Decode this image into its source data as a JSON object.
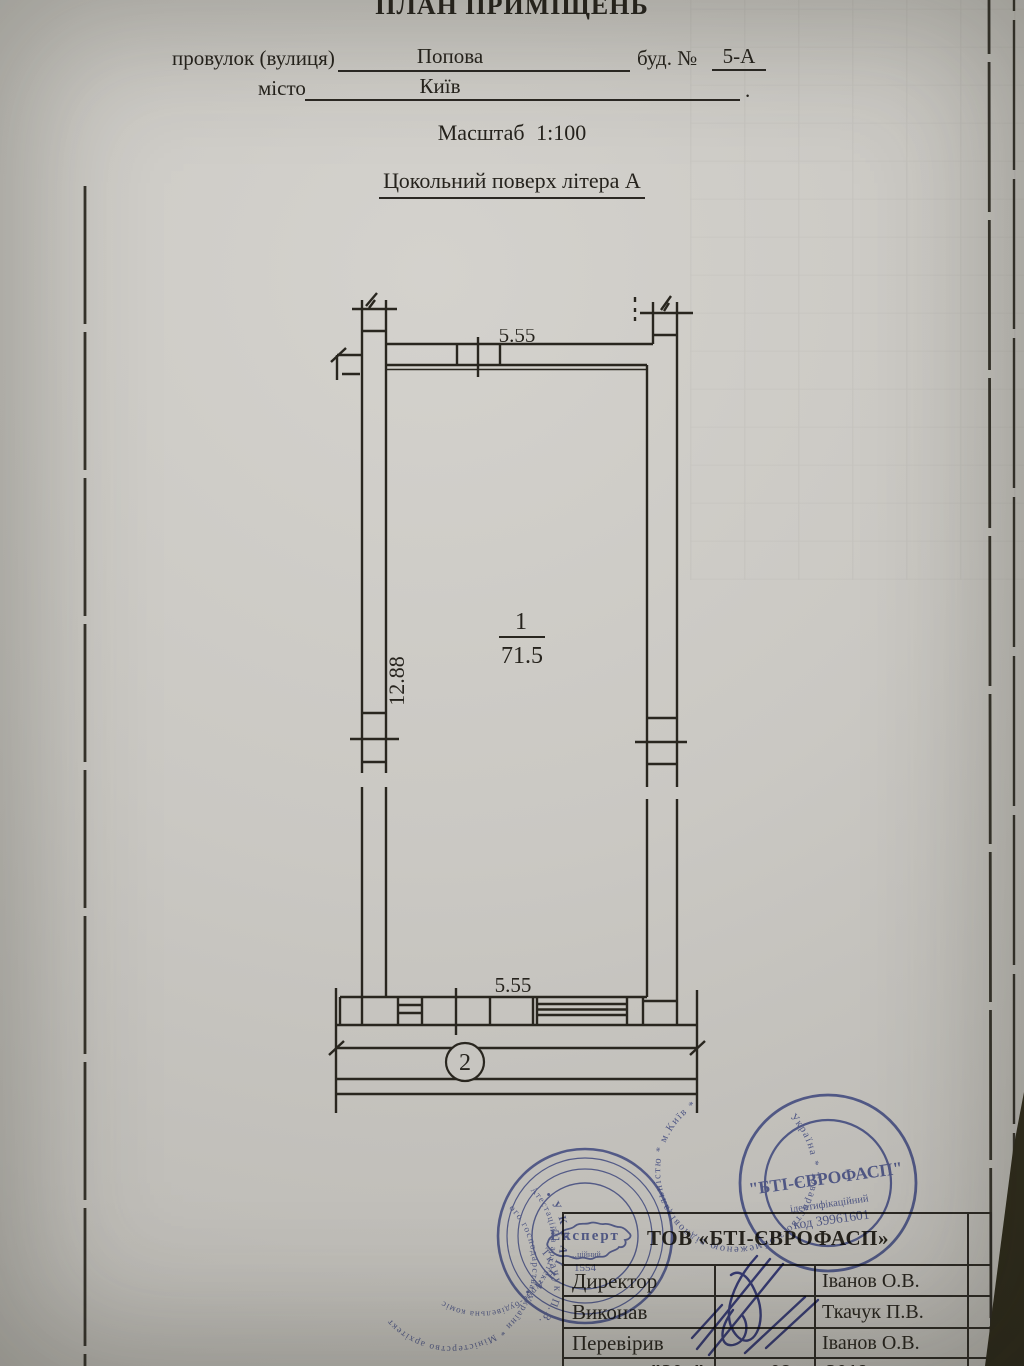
{
  "page": {
    "paper_color": "#cac8c3",
    "ink_color": "#2b2823",
    "stamp_blue": "#4553a4"
  },
  "header": {
    "title": "ПЛАН ПРИМІЩЕНЬ",
    "street_label": "провулок (вулиця)",
    "street_value": "Попова",
    "building_label": "буд. №",
    "building_value": "5-А",
    "city_label": "місто",
    "city_value": "Київ",
    "city_line_end": ".",
    "scale_line": "Масштаб 1:100",
    "floor_line": "Цокольний поверх літера А"
  },
  "plan": {
    "room_number": "1",
    "room_area": "71.5",
    "height_dim": "12.88",
    "width_dim_bottom": "5.55",
    "width_dim_top": "5.55",
    "section_mark": "2"
  },
  "stamps": {
    "left": {
      "ring_outer_fragment": "ого господарства України * Міністерство архітект",
      "ring_middle_fragment": "Атестаційна архітектурно-будівельна коміс",
      "country_ring": "•  У К Р А Ї Н А  •",
      "center_word": "Експерт",
      "name_arc": "Ткачук П.В.",
      "cert_word_fragment": "…ційний",
      "cert_number": "1554"
    },
    "right": {
      "ring_text": "Україна * Товариство з обмеженою відповідальністю * м.Київ *",
      "center_name": "\"БТІ-ЄВРОФАСП\"",
      "id_word": "ідентифікаційний",
      "id_code": "код 39961601"
    }
  },
  "table": {
    "org_title": "ТОВ «БТІ-ЄВРОФАСП»",
    "rows": [
      {
        "label": "Директор",
        "person": "Іванов О.В."
      },
      {
        "label": "Виконав",
        "person": "Ткачук П.В."
      },
      {
        "label": "Перевірив",
        "person": "Іванов О.В."
      }
    ],
    "date_day": "\"20_\"",
    "date_month": "08",
    "date_year": "2019"
  }
}
